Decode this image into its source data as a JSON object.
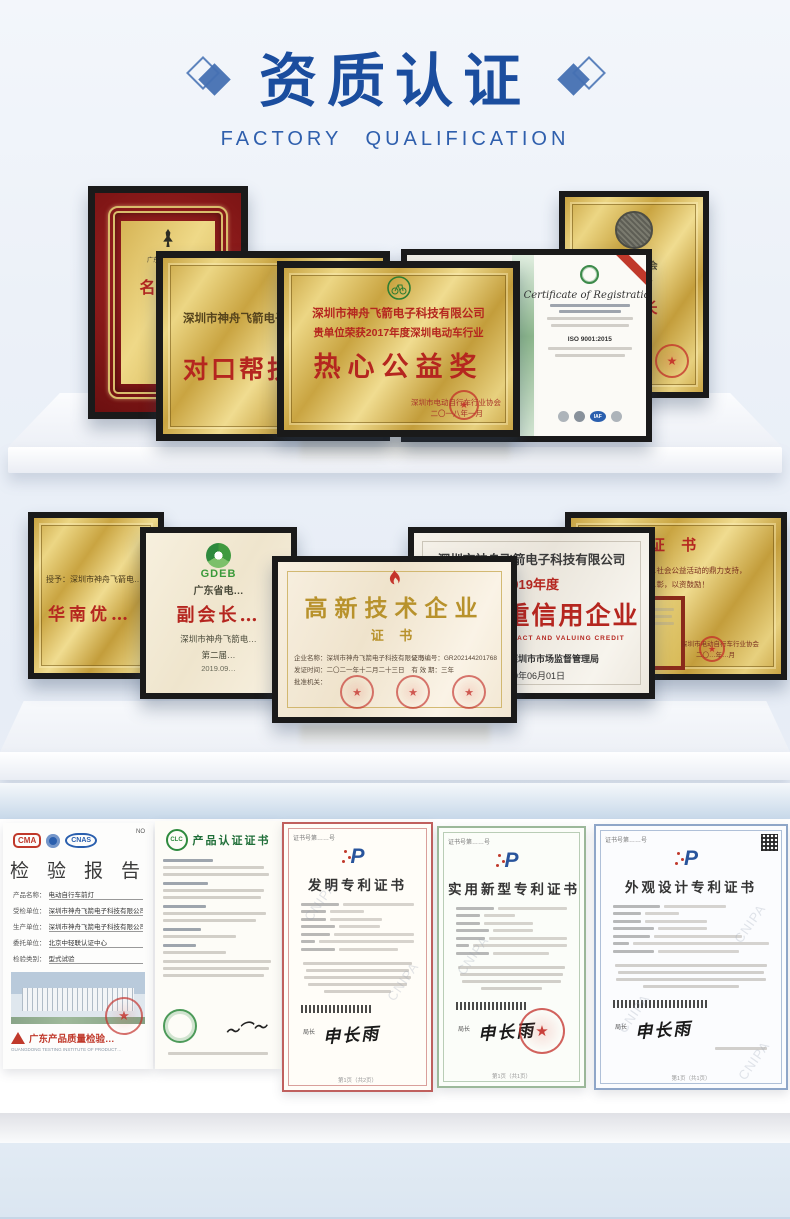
{
  "header": {
    "title": "资质认证",
    "subtitle": "FACTORY QUALIFICATION",
    "accent_color": "#1b4d9e"
  },
  "shelf1": {
    "honor_plaque": {
      "org_line": "广东省中山市…",
      "title": "名誉…",
      "name_line": "何…",
      "footer": "深圳市…"
    },
    "duikou_plaque": {
      "company": "深圳市神舟飞箭电子…",
      "title": "对口帮扶…"
    },
    "gongyi_plaque": {
      "company": "深圳市神舟飞箭电子科技有限公司",
      "award_line": "贵单位荣获2017年度深圳电动车行业",
      "title": "热心公益奖",
      "org": "深圳市电动自行车行业协会",
      "date": "二〇一八年一月"
    },
    "iso_cert": {
      "title": "Certificate of Registration",
      "standard": "ISO 9001:2015",
      "iaf": "IAF"
    },
    "shanghui_plaque": {
      "org": "…新闻商会",
      "stars": "— ☆ ☆ —",
      "title": "…会长",
      "sub": "…长"
    }
  },
  "shelf2": {
    "huanan_plaque": {
      "line": "授予：深圳市神舟飞箭电…",
      "title": "华南优…"
    },
    "gdeb_plaque": {
      "logo": "GDEB",
      "org": "广东省电…",
      "title": "副会长…",
      "company": "深圳市神舟飞箭电…",
      "session": "第二届…",
      "date": "2019.09…"
    },
    "hitech_cert": {
      "title": "高新技术企业",
      "subtitle": "证 书",
      "field1": "企业名称：深圳市神舟飞箭电子科技有限公司",
      "field2": "发证时间：二〇二一年十二月二十三日",
      "field3": "批准机关：",
      "right1": "证书编号：GR202144201768",
      "right2": "有 效 期：三年"
    },
    "contract_plaque": {
      "company": "深圳市神舟飞箭电子科技有限公司",
      "year": "2019年度",
      "title": "守合同重信用企业",
      "english": "OBSERVING CONTRACT AND VALUING CREDIT",
      "issuer": "发证机关：深圳市市场监督管理局",
      "date": "2020年06月01日"
    },
    "zhengshu_plaque": {
      "title": "证 书",
      "line1": "…社会公益活动的鼎力支持，",
      "line2": "…彰，以资鼓励！",
      "org": "深圳市电动自行车行业协会",
      "date": "二〇…年…月"
    }
  },
  "bottom": {
    "report": {
      "no": "NO",
      "cma": "CMA",
      "cnas": "CNAS",
      "title": "检 验 报 告",
      "fields": [
        {
          "label": "产品名称：",
          "value": "电动自行车前灯"
        },
        {
          "label": "受检单位：",
          "value": "深圳市神舟飞箭电子科技有限公司"
        },
        {
          "label": "生产单位：",
          "value": "深圳市神舟飞箭电子科技有限公司"
        },
        {
          "label": "委托单位：",
          "value": "北京中轻联认证中心"
        },
        {
          "label": "检验类别：",
          "value": "型式试验"
        }
      ],
      "org": "广东产品质量检验…",
      "org_en": "GUANGDONG TESTING INSTITUTE OF PRODUCT…"
    },
    "product_cert": {
      "logo": "CLC",
      "title": "产品认证证书"
    },
    "patent_invention": {
      "cert_no": "证书号第……号",
      "title": "发明专利证书",
      "chief": "局长",
      "signature": "申长雨",
      "page": "第1页（共2页）",
      "watermark": "CNIPA"
    },
    "patent_utility": {
      "cert_no": "证书号第……号",
      "title": "实用新型专利证书",
      "chief": "局长",
      "signature": "申长雨",
      "page": "第1页（共1页）",
      "watermark": "CNIPA"
    },
    "patent_design": {
      "cert_no": "证书号第……号",
      "title": "外观设计专利证书",
      "chief": "局长",
      "signature": "申长雨",
      "page": "第1页（共1页）",
      "watermark": "CNIPA"
    }
  }
}
